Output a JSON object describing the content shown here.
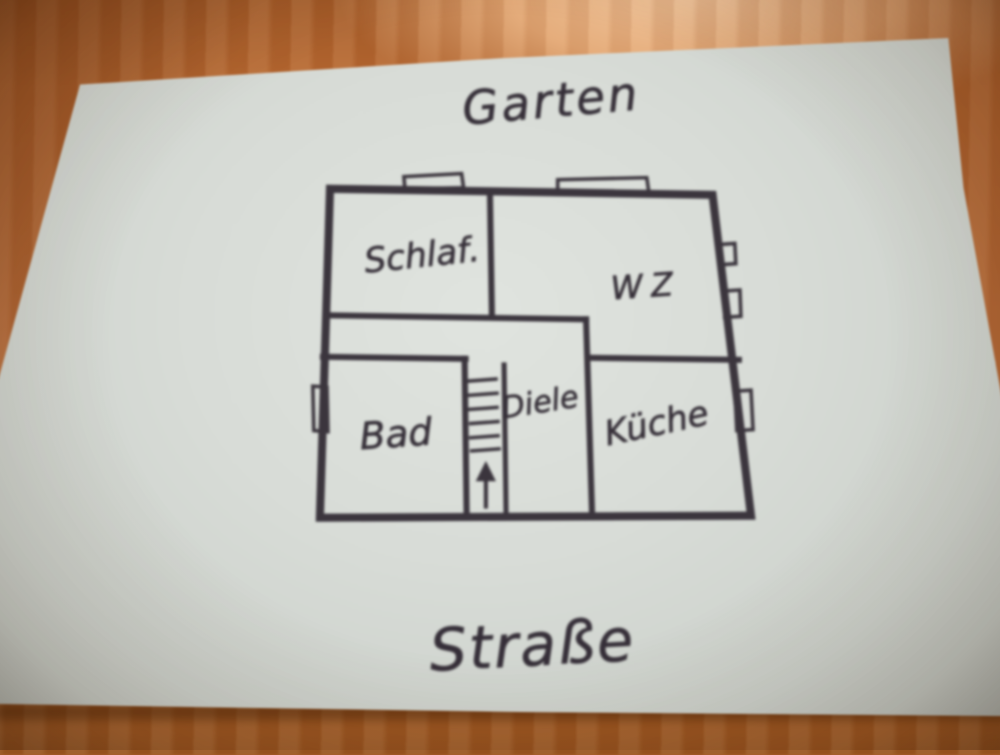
{
  "photo": {
    "ink_color": "#38323a",
    "paper_color": "#d8dcd6",
    "table_wood_color": "#b5682f"
  },
  "floorplan": {
    "area_labels": {
      "top": "Garten",
      "bottom": "Straße"
    },
    "rooms": [
      {
        "label": "Schlaf."
      },
      {
        "label": "WZ"
      },
      {
        "label": "Bad"
      },
      {
        "label": "Diele"
      },
      {
        "label": "Küche"
      }
    ],
    "stairs": {
      "icon": "up-arrow-icon",
      "direction": "up"
    }
  }
}
